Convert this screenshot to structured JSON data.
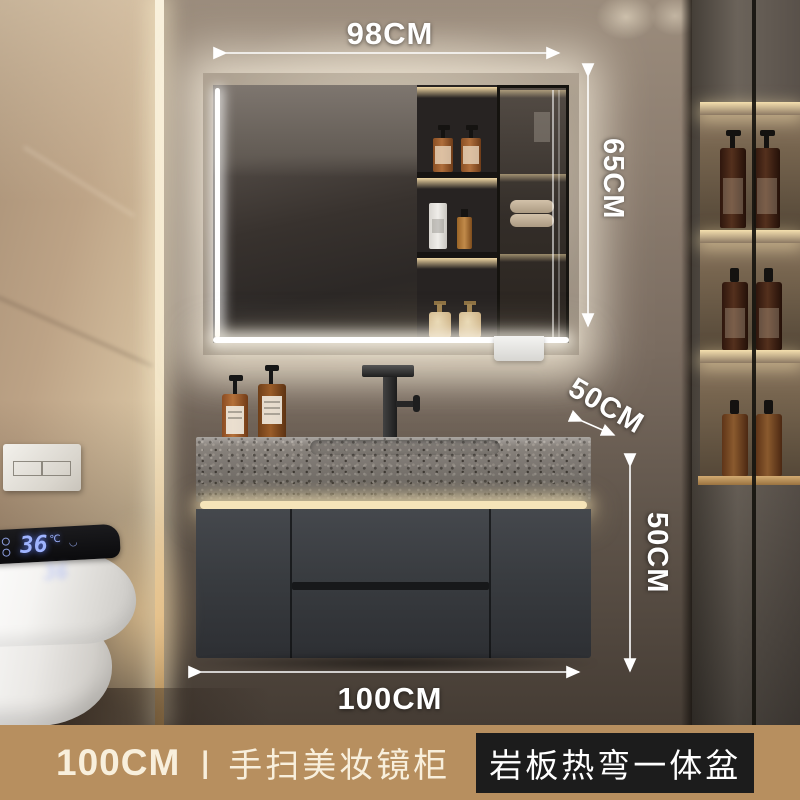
{
  "product": {
    "dimensions": {
      "top_width": "98CM",
      "mirror_height": "65CM",
      "counter_depth": "50CM",
      "cabinet_height": "50CM",
      "bottom_width": "100CM"
    },
    "toilet_display": {
      "temperature": "36",
      "unit": "℃",
      "wave_icon": "◡"
    },
    "banner": {
      "size": "100CM",
      "separator": "丨",
      "name": "手扫美妆镜柜",
      "highlight": "岩板热弯一体盆"
    },
    "colors": {
      "banner_bg": "#b78f5f",
      "highlight_bg": "#1c1c1c",
      "annotation_text": "#ffffff",
      "led_warm": "#f6e4b9",
      "display_digits": "#9fb4ff",
      "vanity_cabinet": "#3a3c40",
      "countertop": "#89837d"
    }
  }
}
